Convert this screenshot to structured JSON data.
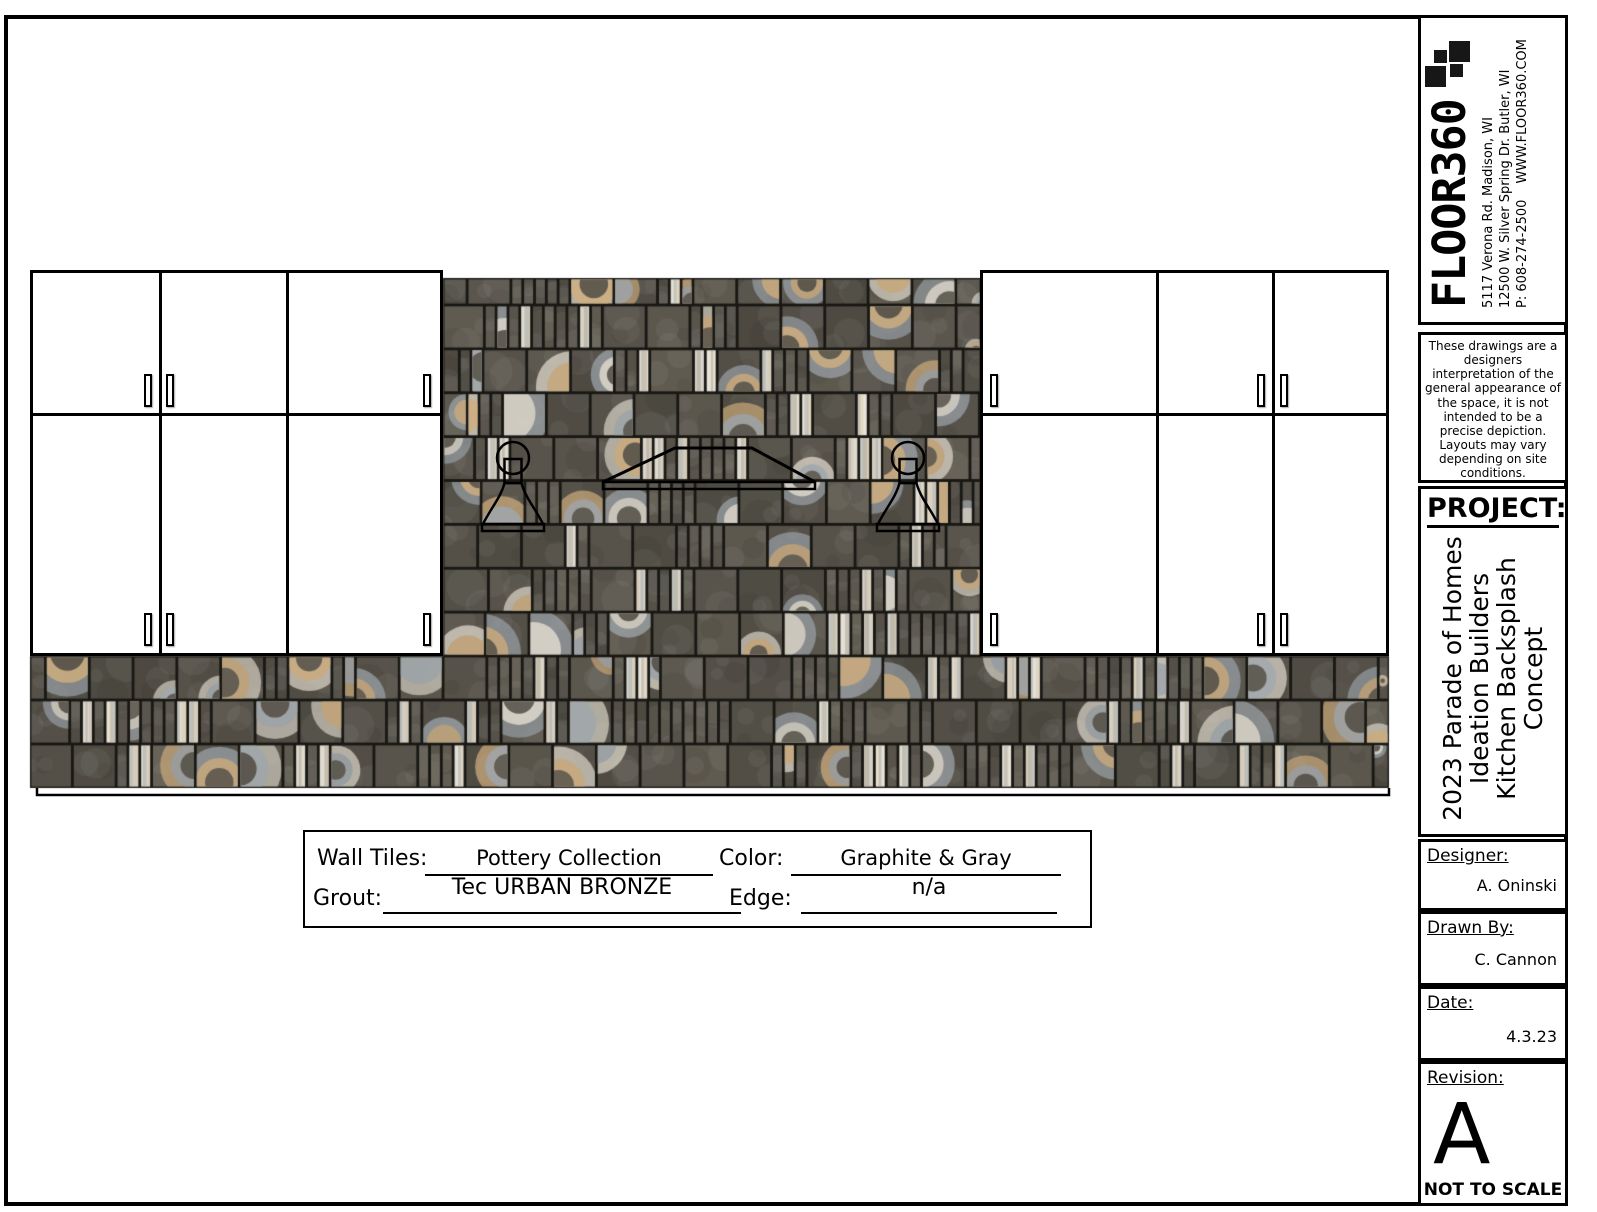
{
  "title_block": {
    "logo": {
      "name": "FLOOR360",
      "address1": "5117 Verona Rd. Madison, WI",
      "address2": "12500 W. Silver Spring Dr. Butler, WI",
      "phone": "P: 608-274-2500",
      "website": "WWW.FLOOR360.COM"
    },
    "disclaimer": "These drawings are a designers interpretation of the general appearance of the space, it is not intended to be a precise depiction. Layouts may vary depending on site conditions.",
    "project": {
      "label": "PROJECT:",
      "lines": [
        "2023 Parade of Homes",
        "Ideation Builders",
        "Kitchen Backsplash",
        "Concept"
      ]
    },
    "designer": {
      "label": "Designer:",
      "value": "A. Oninski"
    },
    "drawn_by": {
      "label": "Drawn By:",
      "value": "C. Cannon"
    },
    "date": {
      "label": "Date:",
      "value": "4.3.23"
    },
    "revision": {
      "label": "Revision:",
      "value": "A"
    },
    "scale_note": "NOT TO SCALE"
  },
  "spec_box": {
    "wall_tiles": {
      "label": "Wall Tiles:",
      "value": "Pottery Collection"
    },
    "color": {
      "label": "Color:",
      "value": "Graphite & Gray"
    },
    "grout": {
      "label": "Grout:",
      "value": "Tec URBAN BRONZE"
    },
    "edge": {
      "label": "Edge:",
      "value": "n/a"
    }
  },
  "tile_palette": {
    "base": "#57534a",
    "grout": "#181713",
    "tan": "#c9a87a",
    "blue_gray": "#9aa1a7",
    "cream": "#d9d3c6",
    "light_strip": "#dcd8cd"
  }
}
